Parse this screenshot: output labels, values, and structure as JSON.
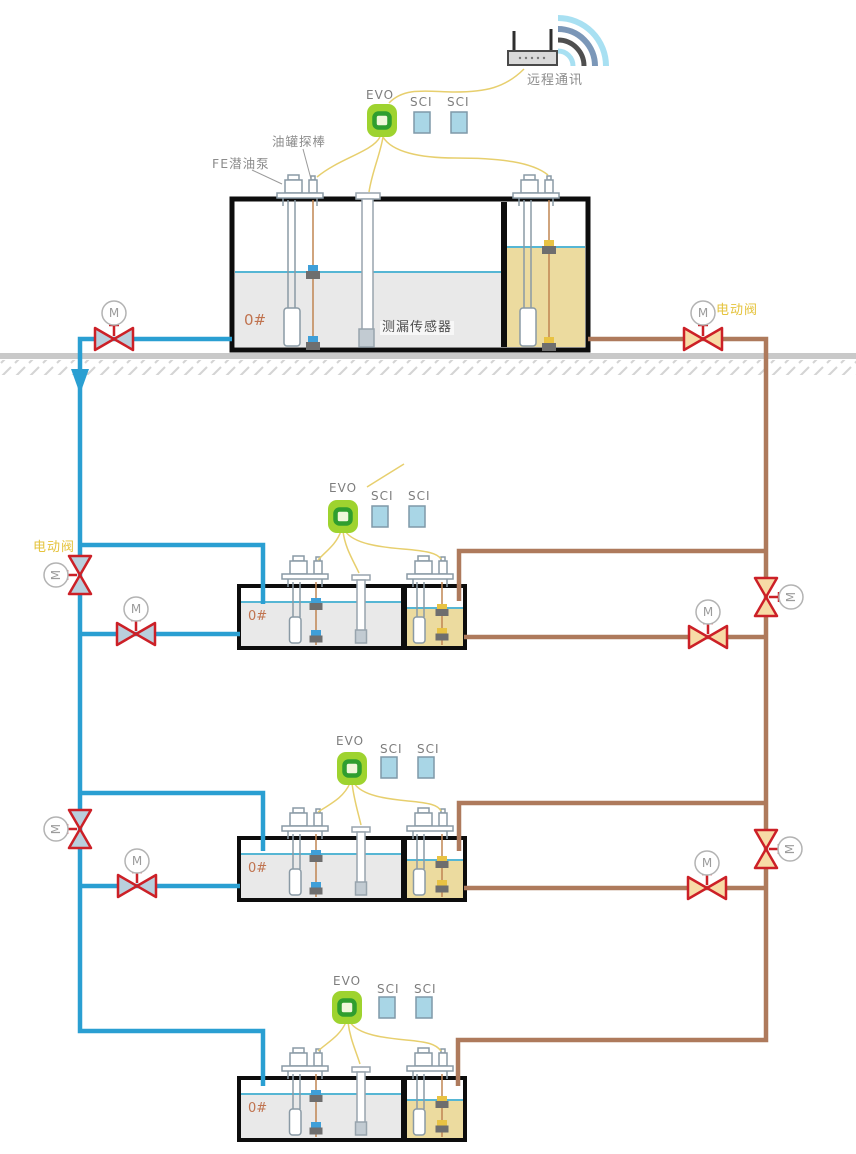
{
  "labels": {
    "remote_comm": "远程通讯",
    "evo": "EVO",
    "sci": "SCI",
    "tank_probe": "油罐探棒",
    "submersible_pump": "FE潜油泵",
    "leak_sensor": "测漏传感器",
    "fuel_grade": "0#",
    "electric_valve": "电动阀",
    "motor": "M"
  },
  "colors": {
    "supply_pipe_blue": "#2a9fd2",
    "return_pipe_brown": "#ae7a5c",
    "valve_red": "#cc2027",
    "valve_fill_blue": "#b9cfdd",
    "valve_fill_tan": "#f7dba6",
    "evo_green": "#9ed32f",
    "evo_ring_green": "#2f9e2f",
    "sci_blue": "#a9d6e6",
    "wire_yellow": "#e7cf6e",
    "diesel_liquid_gray": "#e9e9e9",
    "fuel_liquid_khaki": "#ecdb9f",
    "surface_line_blue": "#56b6d4",
    "ground_gray": "#c9c9c9",
    "electric_valve_label": "#e5c33c",
    "grade_label": "#c0734f"
  }
}
